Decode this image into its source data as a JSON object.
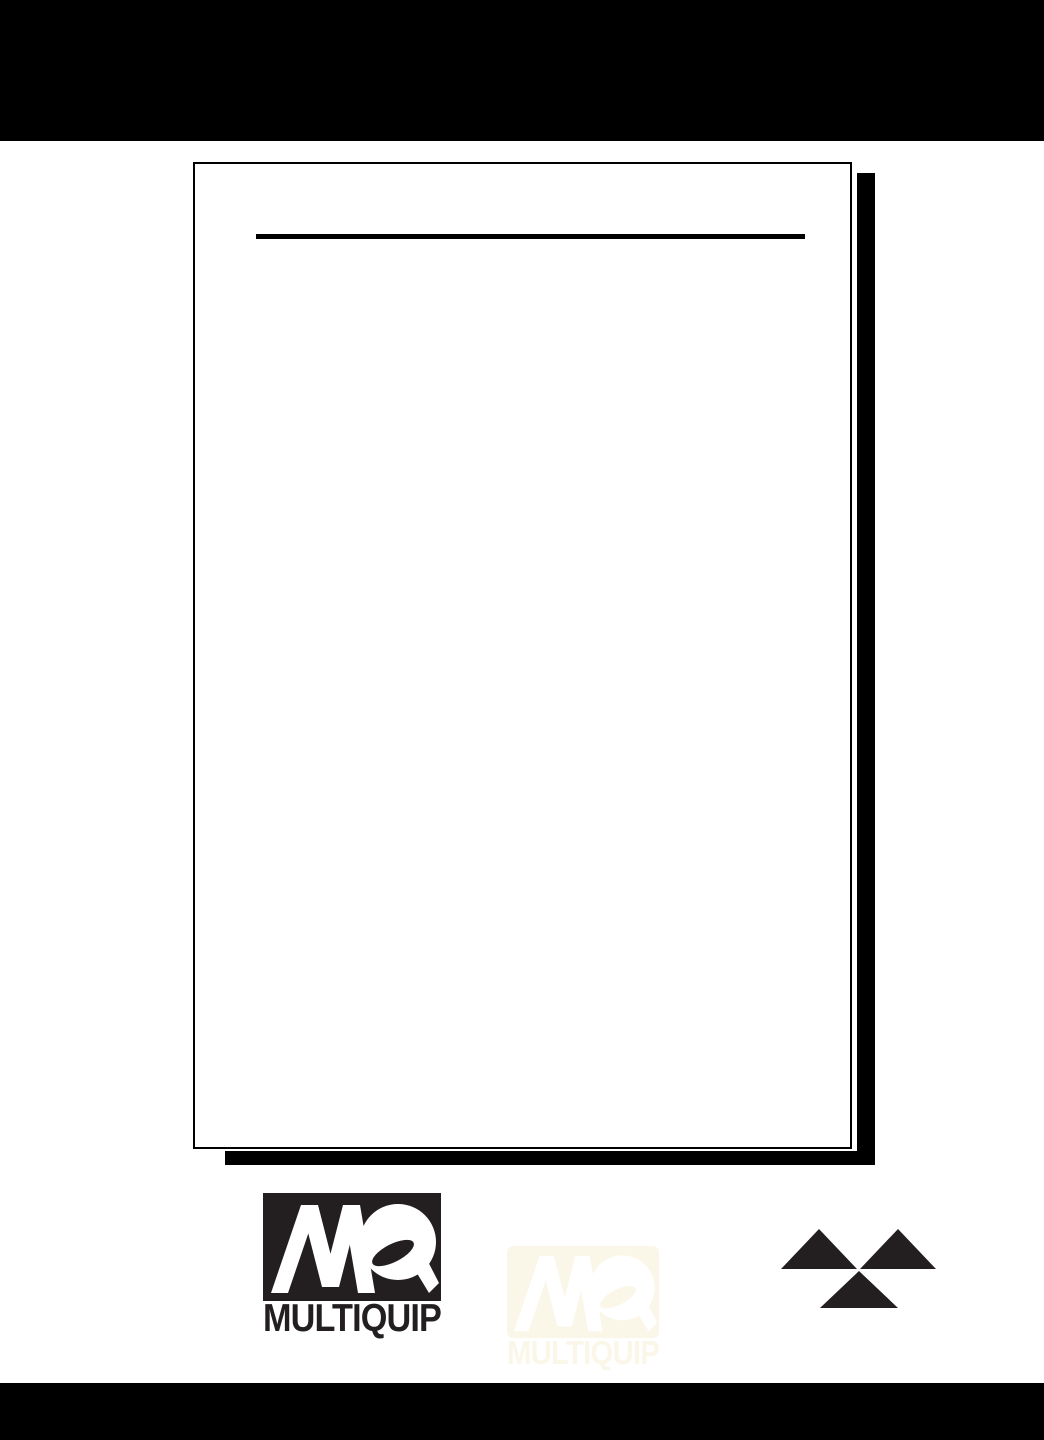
{
  "document": {
    "kind": "manual-cover-sheet",
    "sheet_background": "#ffffff",
    "band_color": "#000000",
    "sheet_border_color": "#000000",
    "sheet_shadow_color": "#000000",
    "divider_color": "#000000"
  },
  "logos": {
    "multiquip": {
      "monogram": "MQ",
      "wordmark": "MULTIQUIP",
      "ink_color": "#231f20",
      "letter_color": "#ffffff"
    },
    "watermark": {
      "monogram": "MQ",
      "wordmark": "MULTIQUIP",
      "ink_color": "#faf6e8",
      "letter_color": "#ffffff"
    },
    "triangle_emblem": {
      "triangle_count": 3,
      "color": "#231f20"
    }
  }
}
